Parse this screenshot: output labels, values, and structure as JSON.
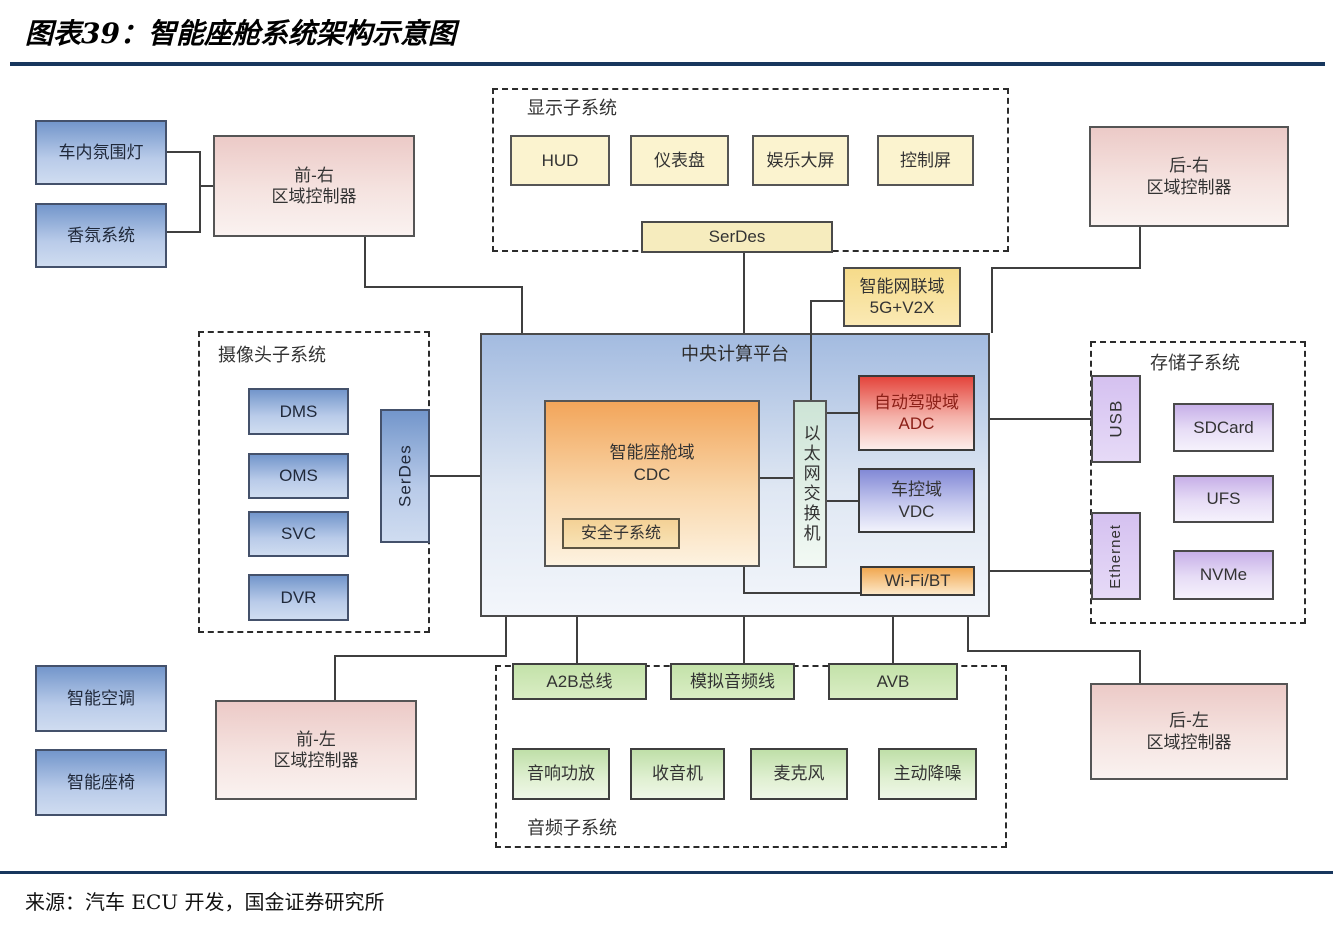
{
  "title": "图表39：智能座舱系统架构示意图",
  "source": "来源：汽车 ECU 开发，国金证券研究所",
  "colors": {
    "rule_navy": "#17365d",
    "blue_box": "#7396cb",
    "pink_box": "#eccac7",
    "yellow_box": "#fbf3cf",
    "orange_cdc": "#f2a55a",
    "red_adc": "#e4453c",
    "violet_vdc": "#8289d6",
    "green_box": "#c3e2a9",
    "purple_box": "#c7b0e8",
    "line": "#3f3f3f"
  },
  "groups": {
    "display": "显示子系统",
    "camera": "摄像头子系统",
    "storage": "存储子系统",
    "audio": "音频子系统"
  },
  "nodes": {
    "ambient_light": "车内氛围灯",
    "fragrance": "香氛系统",
    "front_right": "前-右\n区域控制器",
    "rear_right": "后-右\n区域控制器",
    "front_left": "前-左\n区域控制器",
    "rear_left": "后-左\n区域控制器",
    "smart_ac": "智能空调",
    "smart_seat": "智能座椅",
    "hud": "HUD",
    "cluster": "仪表盘",
    "entertainment": "娱乐大屏",
    "control_screen": "控制屏",
    "serdes_display": "SerDes",
    "telematics": "智能网联域\n5G+V2X",
    "platform": "中央计算平台",
    "cdc": "智能座舱域\nCDC",
    "safety": "安全子系统",
    "eth_switch": "以太网交换机",
    "adc": "自动驾驶域\nADC",
    "vdc": "车控域\nVDC",
    "wifi_bt": "Wi-Fi/BT",
    "dms": "DMS",
    "oms": "OMS",
    "svc": "SVC",
    "dvr": "DVR",
    "serdes_camera": "SerDes",
    "usb": "USB",
    "ethernet": "Ethernet",
    "sdcard": "SDCard",
    "ufs": "UFS",
    "nvme": "NVMe",
    "a2b": "A2B总线",
    "analog_audio": "模拟音频线",
    "avb": "AVB",
    "amplifier": "音响功放",
    "radio": "收音机",
    "microphone": "麦克风",
    "anc": "主动降噪"
  }
}
